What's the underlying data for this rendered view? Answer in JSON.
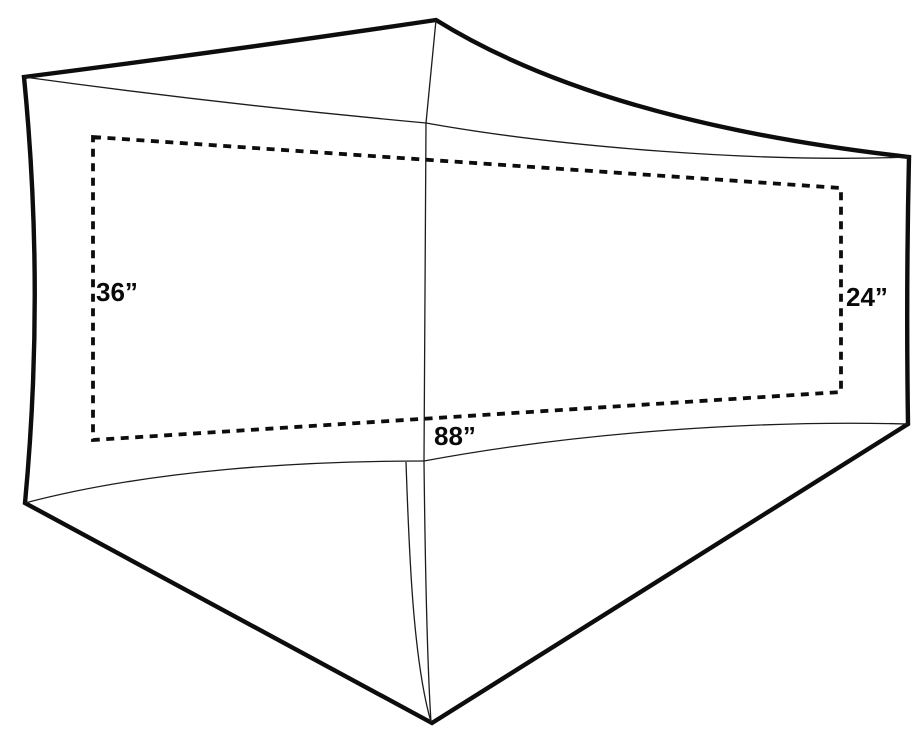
{
  "diagram": {
    "kind": "tent-footprint-top-view",
    "labels": {
      "left_width": "36”",
      "right_width": "24”",
      "length": "88”"
    },
    "dimensions_inches": {
      "left_width": 36,
      "right_width": 24,
      "length": 88
    },
    "colors": {
      "outline": "#0d0d0d",
      "seam": "#1c1c1c",
      "dashed": "#0d0d0d",
      "background": "#ffffff"
    }
  }
}
